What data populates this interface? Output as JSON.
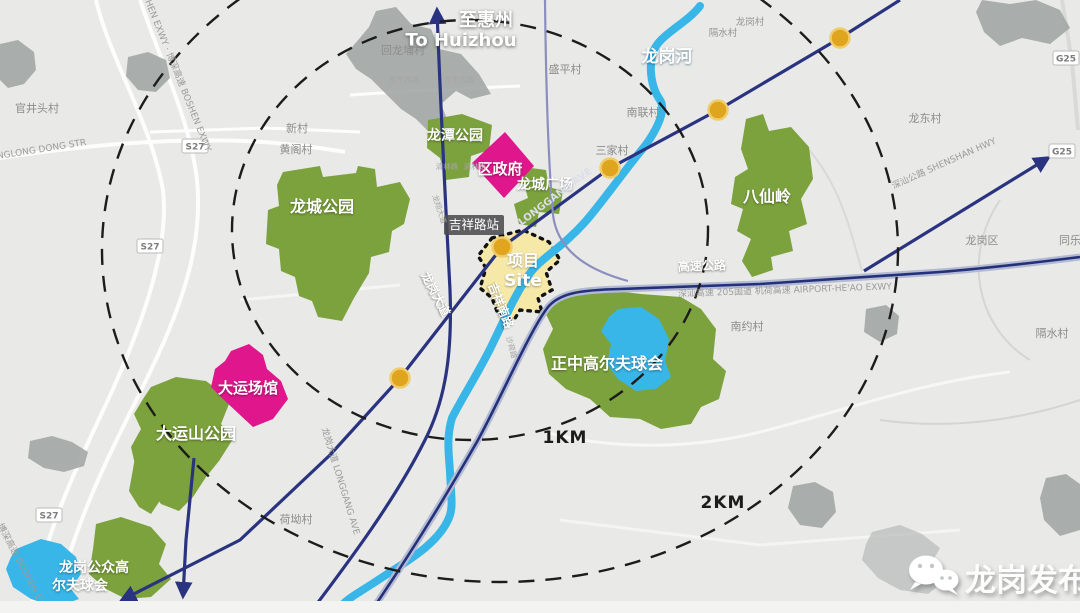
{
  "map": {
    "direction": {
      "cn": "至惠州",
      "en": "To Huizhou"
    },
    "river": "龙岗河",
    "station": "吉祥路站",
    "site": {
      "cn": "项目",
      "en": "Site"
    },
    "rings": {
      "inner": "1KM",
      "outer": "2KM"
    },
    "parks": {
      "longcheng": "龙城公园",
      "longtan": "龙潭公园",
      "square": "龙城广场",
      "baxianling": "八仙岭",
      "dayunshan": "大运山公园",
      "golf": "正中高尔夫球会",
      "public_golf1": "龙岗公众高",
      "public_golf2": "尔夫球会"
    },
    "venues": {
      "gov": "区政府",
      "universiade": "大运场馆"
    },
    "villages": {
      "guanjingtou": "官井头村",
      "xincun": "新村",
      "huangge": "黄阁村",
      "huilongpu": "回龙埔村",
      "shengping": "盛平村",
      "longgangcun": "龙岗村",
      "geshui": "隔水村",
      "nanlian": "南联村",
      "sanjia": "三家村",
      "longdong": "龙东村",
      "longgangqu": "龙岗区",
      "tongle": "同乐",
      "nanyue": "南约村",
      "heao": "荷坳村",
      "geshui2": "隔水村"
    },
    "roads": {
      "longgang_cn": "龙岗大道",
      "jixiang": "吉祥南路",
      "longgang_en": "LONGGANG AVE",
      "longgang_mix": "龙岗大道 LONGGANG AVE",
      "expwy_cn": "高速公路",
      "expwy_detail": "深汕高速 205国道 机荷高速 AIRPORT-HE'AO EXWY",
      "shenshan": "深汕公路 SHENSHAN HWY",
      "boshen1": "BOSHEN EXWY · 博深高速 BOSHEN EXWY",
      "boshen2": "博深高速 BOSHEN EXWY",
      "donglong": "NGLONG DONG STR",
      "qinglin": "清林路",
      "longxiang": "龙翔大道",
      "shahe": "沙荷路",
      "longping": "龙平西路"
    },
    "shields": {
      "s27": "S27",
      "g25": "G25"
    },
    "watermark": "龙岗发布",
    "colors": {
      "park_green": "#7ca23d",
      "venue_magenta": "#e0168c",
      "river_cyan": "#38b6e8",
      "metro_navy": "#2a3380",
      "site_yellow": "#f6e9a8",
      "station_dot": "#dfa51f",
      "ring_black": "#1c1c1c"
    }
  }
}
